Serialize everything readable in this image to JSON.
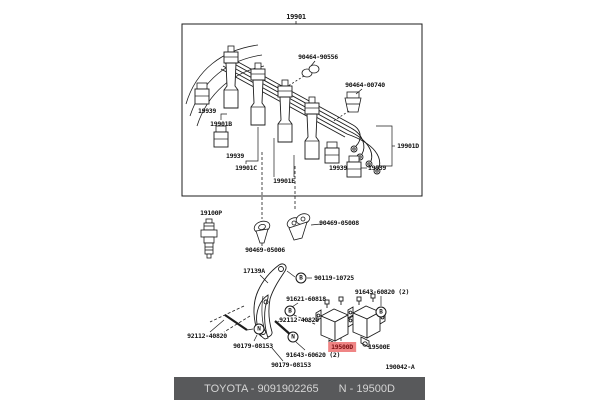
{
  "diagram": {
    "parts": {
      "cord_set": "19901",
      "clamp_a": "90464-90556",
      "clamp_b": "90464-00740",
      "holder": "19939",
      "cord_no2": "19901B",
      "cord_no3": "19901C",
      "cord_no4": "19901D",
      "cord_no5": "19901E",
      "spark_plug": "19100P",
      "sensor_a": "90469-05006",
      "sensor_b": "90469-05008",
      "bracket": "17139A",
      "bolt_upper": "90119-10725",
      "bolt_mid": "91621-60818",
      "stud": "92112-40820",
      "nut": "90179-08153",
      "bolt_right": "91643-60820 (2)",
      "bolt_lower": "91643-60620 (2)",
      "coil_no1": "19500D",
      "coil_no2": "19500E"
    },
    "callouts": {
      "bolt": "B",
      "nut": "N"
    },
    "figure_code": "190042-A",
    "highlight": {
      "part": "19500D",
      "bg": "#ef8585",
      "text_color": "#7c1114"
    },
    "line_color": "#1c1c1c"
  },
  "footer": {
    "left": "TOYOTA - 9091902265",
    "right": "N - 19500D",
    "bg": "#58595b",
    "text_color": "#d4d4d4"
  }
}
